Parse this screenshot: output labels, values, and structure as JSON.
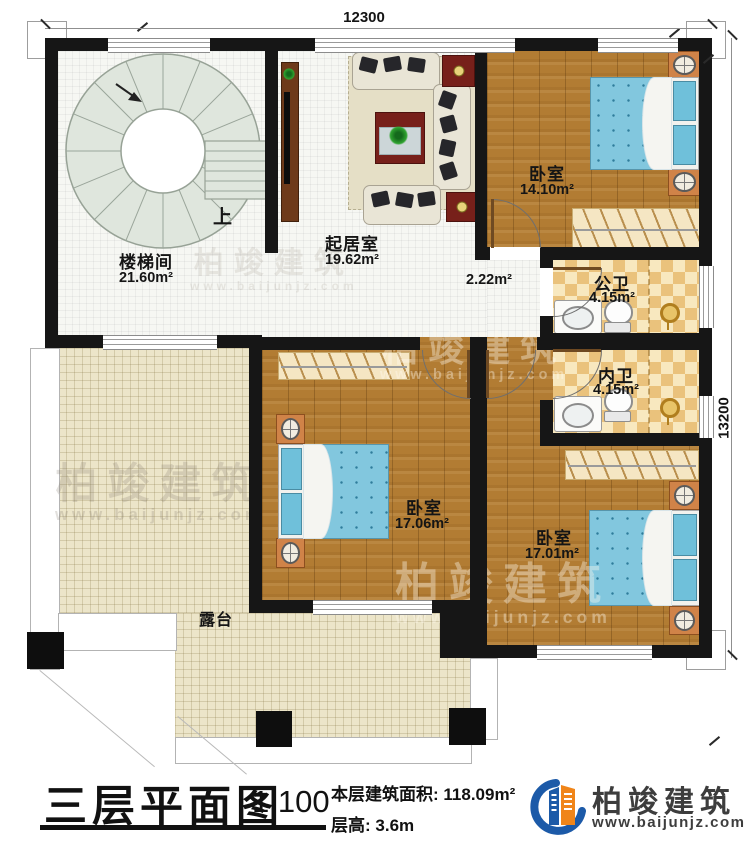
{
  "dimensions": {
    "width_mm": "12300",
    "height_mm": "13200"
  },
  "rooms": {
    "stairwell": {
      "name": "楼梯间",
      "area": "21.60m²"
    },
    "stair_direction": "上",
    "living_room": {
      "name": "起居室",
      "area": "19.62m²"
    },
    "hallway": {
      "area": "2.22m²"
    },
    "bedroom_top_right": {
      "name": "卧室",
      "area": "14.10m²"
    },
    "public_bathroom": {
      "name": "公卫",
      "area": "4.15m²"
    },
    "private_bathroom": {
      "name": "内卫",
      "area": "4.15m²"
    },
    "bedroom_middle": {
      "name": "卧室",
      "area": "17.06m²"
    },
    "bedroom_bottom_right": {
      "name": "卧室",
      "area": "17.01m²"
    },
    "terrace": {
      "name": "露台"
    }
  },
  "title_block": {
    "title": "三层平面图",
    "scale": "1:100",
    "floor_area_label": "本层建筑面积:",
    "floor_area_value": "118.09m²",
    "floor_height_label": "层高:",
    "floor_height_value": "3.6m"
  },
  "branding": {
    "company": "柏竣建筑",
    "website": "www.baijunjz.com",
    "logo_blue": "#1c5aa8",
    "logo_orange": "#f08519"
  }
}
